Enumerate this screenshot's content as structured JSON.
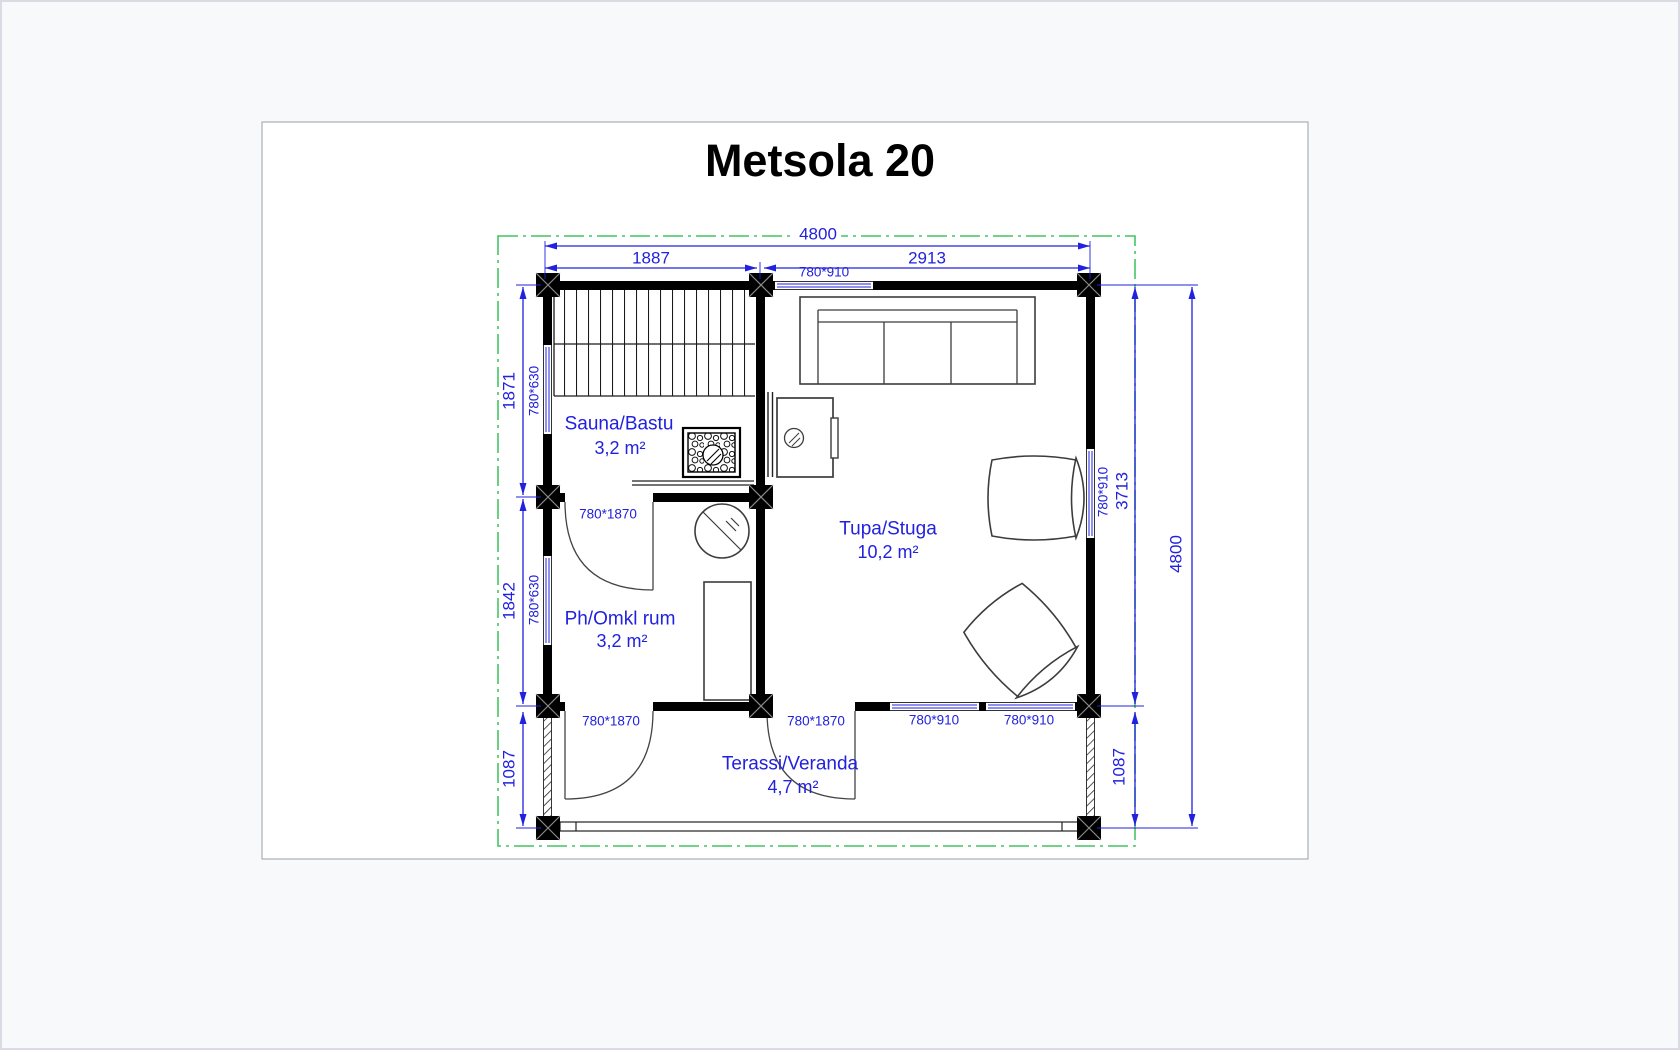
{
  "title": "Metsola 20",
  "colors": {
    "dimension_blue": "#2121df",
    "roof_outline_green": "#45c463",
    "wall_black": "#000000",
    "sheet_border": "#9aa0a6"
  },
  "rooms": [
    {
      "name": "Sauna/Bastu",
      "area": "3,2 m²"
    },
    {
      "name": "Ph/Omkl rum",
      "area": "3,2 m²"
    },
    {
      "name": "Tupa/Stuga",
      "area": "10,2 m²"
    },
    {
      "name": "Terassi/Veranda",
      "area": "4,7 m²"
    }
  ],
  "dimensions": {
    "overall_width": "4800",
    "overall_depth": "4800",
    "sauna_width": "1887",
    "living_width": "2913",
    "sauna_depth": "1871",
    "dressing_depth": "1842",
    "main_depth": "3713",
    "terrace_depth_left": "1087",
    "terrace_depth_right": "1087"
  },
  "openings": {
    "top_window": "780*910",
    "left_window_sauna": "780*630",
    "left_window_dressing": "780*630",
    "right_window": "780*910",
    "sauna_door": "780*1870",
    "terrace_door_left": "780*1870",
    "terrace_door_right": "780*1870",
    "terrace_window_1": "780*910",
    "terrace_window_2": "780*910"
  }
}
